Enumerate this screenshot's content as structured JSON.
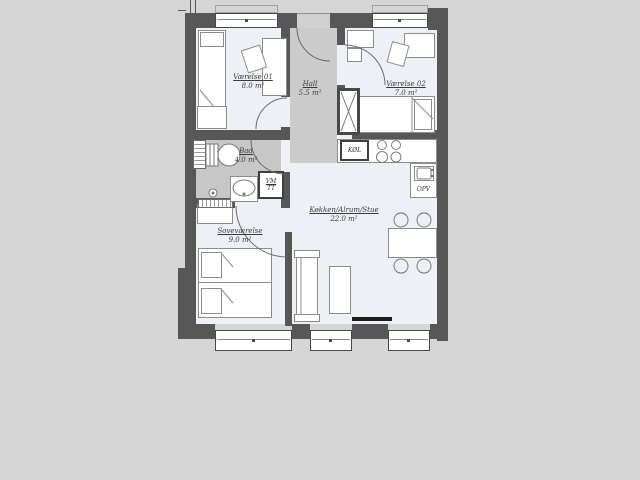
{
  "plan_title": "Apartment floor plan",
  "rooms": [
    {
      "name": "Værelse 01",
      "area": "8.0 m²"
    },
    {
      "name": "Hall",
      "area": "5.5 m²"
    },
    {
      "name": "Værelse 02",
      "area": "7.0 m²"
    },
    {
      "name": "Bad",
      "area": "4.0 m²"
    },
    {
      "name": "Soveværelse",
      "area": "9.0 m²"
    },
    {
      "name": "Køkken/Alrum/Stue",
      "area": "22.0 m²"
    }
  ],
  "appliances": {
    "fridge": "KØL",
    "dishwasher": "OPV",
    "washer": "VM",
    "dryer": "TT"
  },
  "colors": {
    "bg": "#d5d5d5",
    "wall": "#575757",
    "room": "#edf1f5",
    "hall": "#cbcbcb",
    "bath": "#c7c7c7"
  }
}
